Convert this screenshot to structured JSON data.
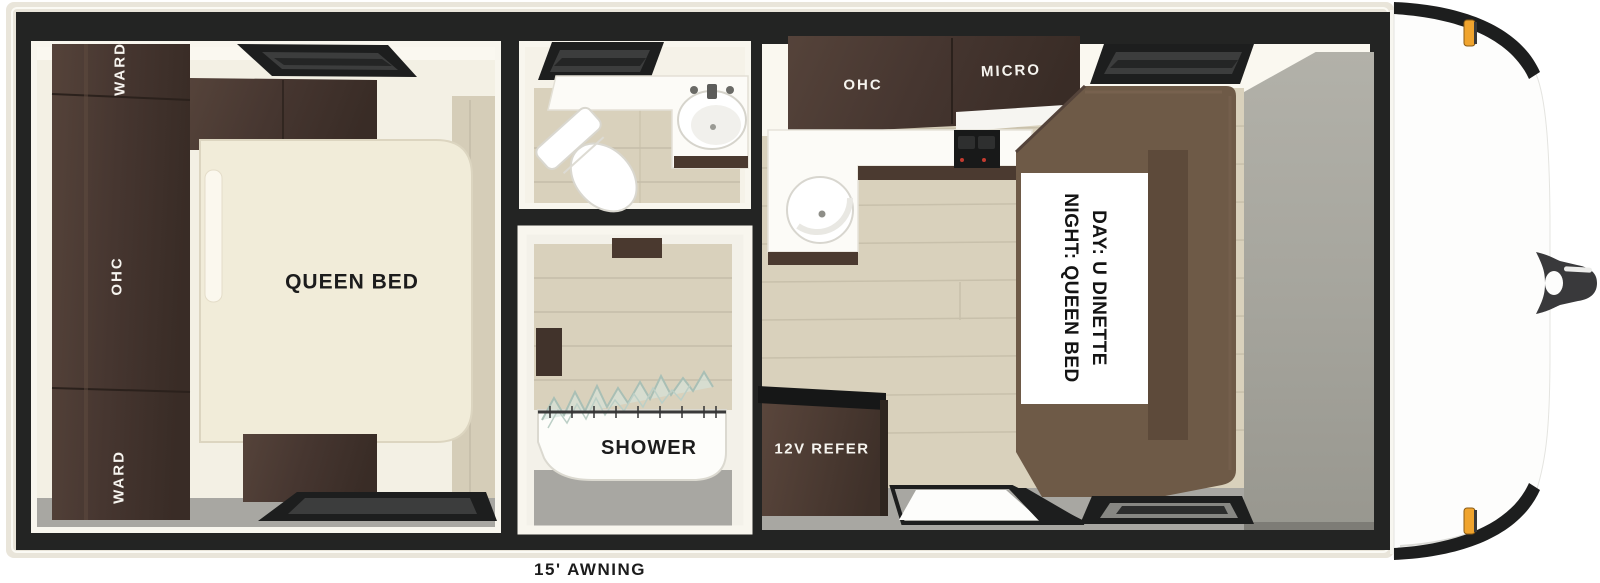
{
  "floorplan": {
    "bedroom": {
      "wardrobe_top_label": "WARD",
      "overhead_cabinet_label": "OHC",
      "wardrobe_bottom_label": "WARD",
      "bed_label": "QUEEN BED"
    },
    "bathroom": {},
    "shower": {
      "label": "SHOWER"
    },
    "kitchen": {
      "overhead_cabinet_label": "OHC",
      "microwave_label": "MICRO",
      "refrigerator_label": "12V REFER"
    },
    "dinette": {
      "day_label": "DAY: U DINETTE",
      "night_label": "NIGHT: QUEEN BED"
    },
    "exterior": {
      "awning_label": "15' AWNING"
    },
    "colors": {
      "wall": "#232423",
      "outer_trim": "#e9e5da",
      "cabinet_wood": "#4a392f",
      "dinette_wood": "#6e5a47",
      "floor_wood": "#d9d1bc",
      "floor_gray": "#a8a7a2",
      "bed_cream": "#f1ecd9",
      "marker_light_amber": "#f0a42e"
    }
  }
}
